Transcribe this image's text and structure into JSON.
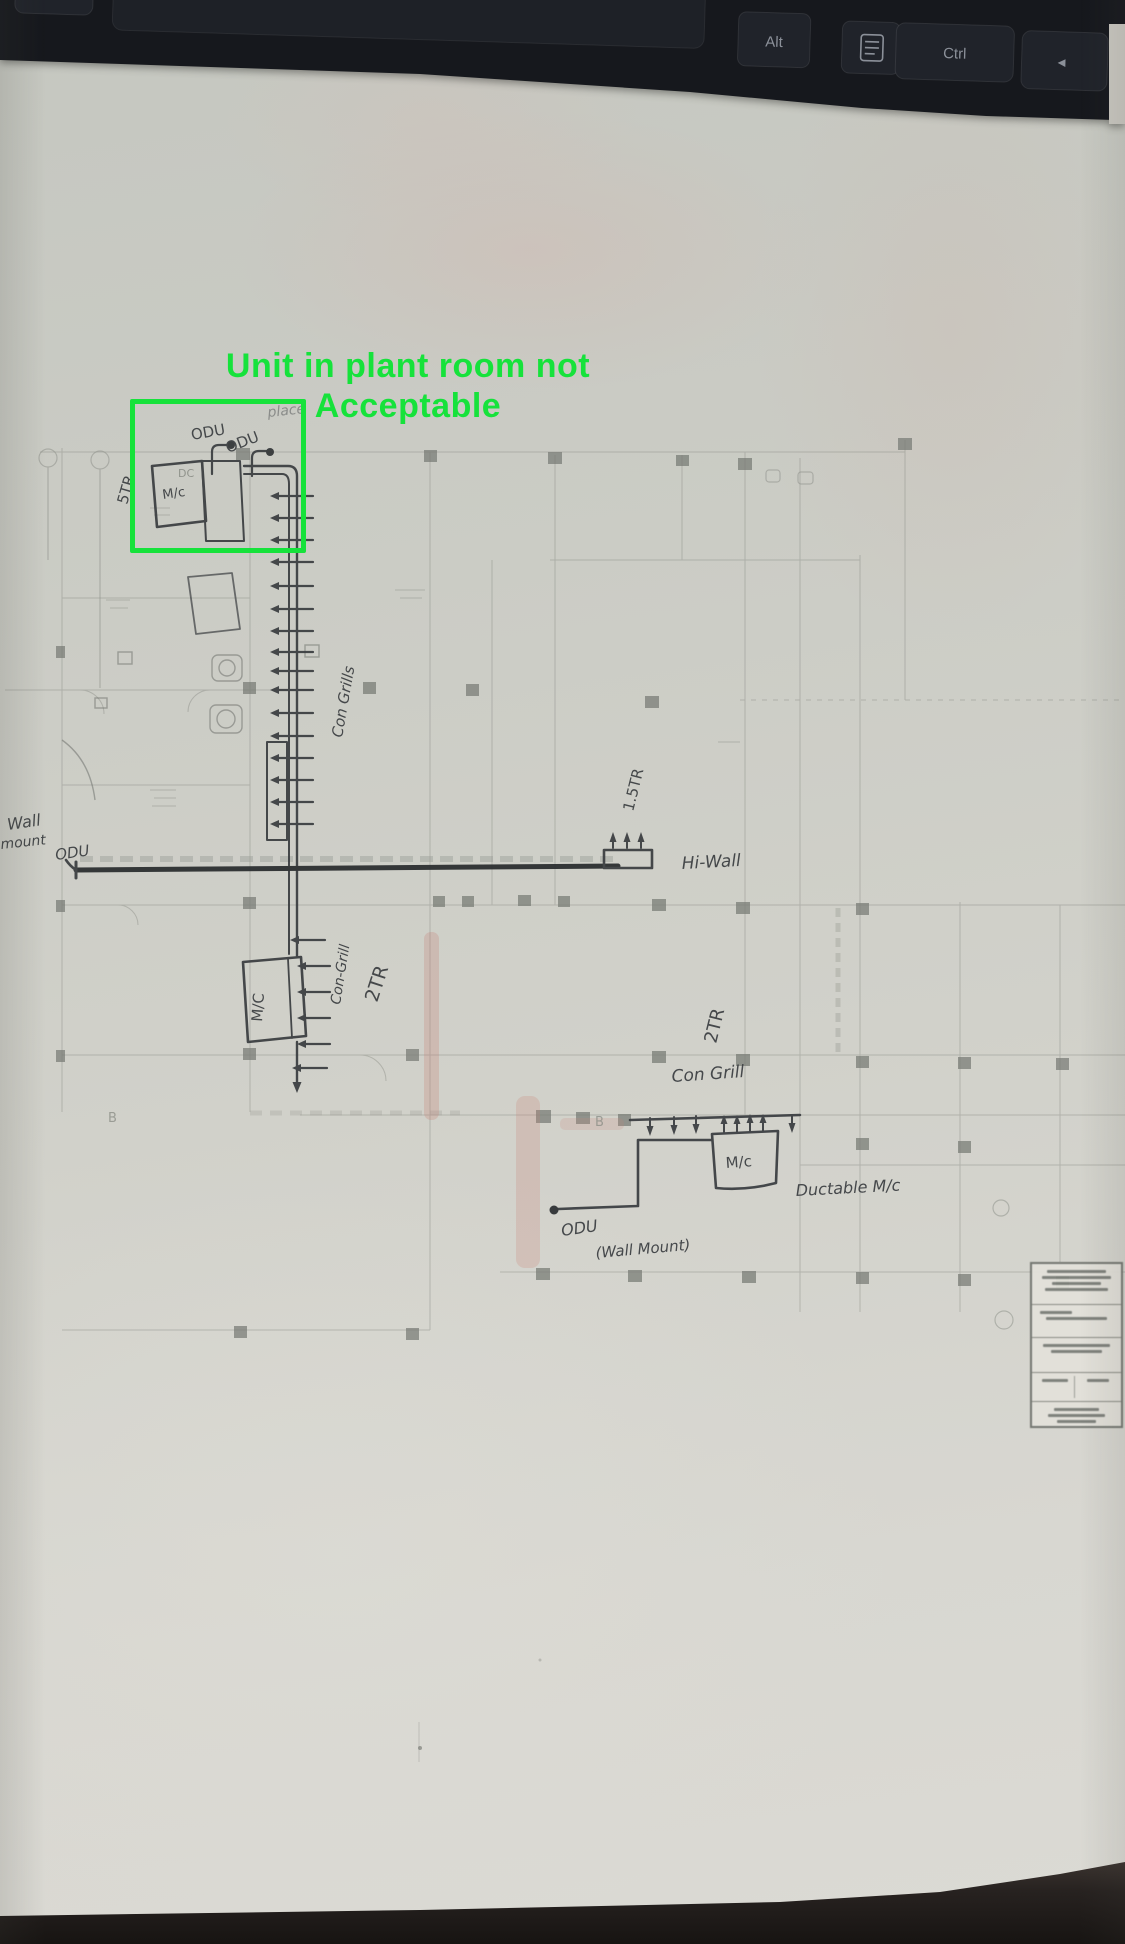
{
  "keyboard": {
    "key_alt_left": "Alt",
    "key_alt_right": "Alt",
    "key_ctrl": "Ctrl",
    "key_arrow_left": "◄",
    "menu_key_icon": "menu-icon"
  },
  "annotation": {
    "line1": "Unit in plant room not",
    "line2": "Acceptable",
    "color": "#16e23b"
  },
  "plan": {
    "printed": {
      "grid_label_dc": "DC",
      "grid_letter_b_left": "B",
      "grid_letter_b_mid": "B"
    },
    "upper_unit": {
      "odu_label_1": "ODU",
      "odu_label_2": "ODU",
      "pencil_note": "place",
      "unit_label": "M/c",
      "capacity": "5TR",
      "grill_label": "Con Grills"
    },
    "wall_mount_odu": {
      "word1": "Wall",
      "word2": "mount",
      "word3": "ODU"
    },
    "hi_wall": {
      "label": "Hi-Wall",
      "capacity": "1.5TR"
    },
    "mid_unit": {
      "unit_label": "M/C",
      "grill_label": "Con-Grill",
      "capacity": "2TR"
    },
    "lower_unit": {
      "capacity": "2TR",
      "grill_label": "Con Grill",
      "unit_label": "M/c",
      "type_label": "Ductable M/c",
      "odu_label": "ODU",
      "odu_mount": "(Wall Mount)"
    }
  },
  "colors": {
    "ink": "#3d4043",
    "paper": "#cdcfc8",
    "annotation_green": "#16e23b",
    "keyboard_black": "#16181d"
  }
}
